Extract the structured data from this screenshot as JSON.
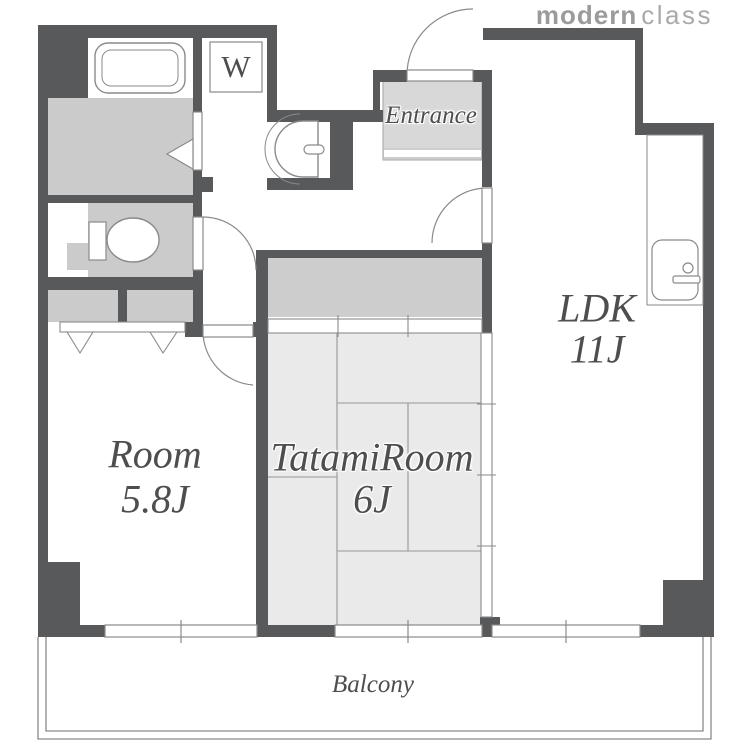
{
  "title": "Apartment floor plan",
  "logo": {
    "part_bold": "modern",
    "part_light": "class"
  },
  "labels": {
    "ldk": {
      "name": "LDK",
      "size": "11J"
    },
    "room": {
      "name": "Room",
      "size": "5.8J"
    },
    "tatami": {
      "name": "TatamiRoom",
      "size": "6J"
    },
    "entrance": "Entrance",
    "balcony": "Balcony",
    "washer": "W"
  },
  "icons": {
    "bathtub": "bathtub-icon",
    "toilet": "toilet-icon",
    "washbasin": "washbasin-icon",
    "kitchen_sink": "kitchen-sink-icon",
    "washing_machine": "washing-machine-icon"
  },
  "colors": {
    "wall": "#58595B",
    "room_gray": "#CBCBCB",
    "closet_gray": "#CDCDCD",
    "tatami_floor": "#EAEAEA",
    "entrance_gray": "#D8D8D8",
    "fixture_line": "#8A8A8A",
    "mat_line": "#979797",
    "label_text": "#4E4E4E",
    "logo_bold": "#9B9B9B",
    "logo_light": "#A9A9A9"
  }
}
